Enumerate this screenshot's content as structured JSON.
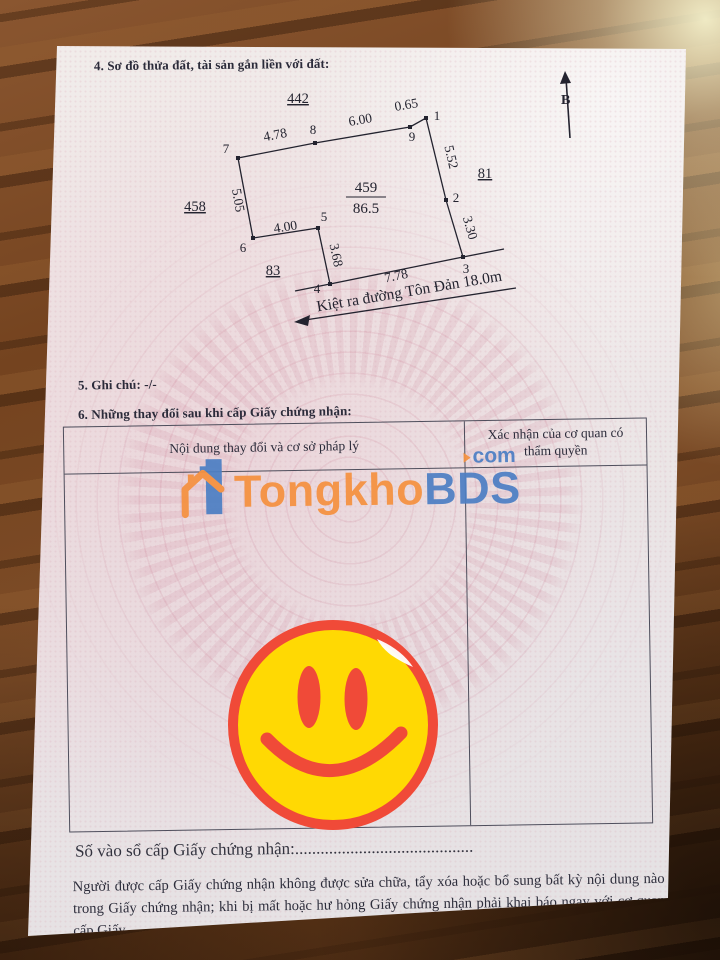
{
  "document": {
    "section4_title": "4. Sơ đồ thửa đất, tài sản gắn liền với đất:",
    "section5_note": "5. Ghi chú: -/-",
    "section6_title": "6. Những thay đổi sau khi cấp Giấy chứng nhận:",
    "table": {
      "col1_header": "Nội dung thay đổi và cơ sở pháp lý",
      "col2_header": "Xác nhận của cơ quan có thẩm quyền"
    },
    "registry_label": "Số vào sổ cấp Giấy chứng nhận:",
    "registry_dots": "..........................................",
    "footer_note": "Người được cấp Giấy chứng nhận không được sửa chữa, tẩy xóa hoặc bổ sung bất kỳ nội dung nào trong Giấy chứng nhận; khi bị mất hoặc hư hỏng Giấy chứng nhận phải khai báo ngay với cơ quan cấp Giấy."
  },
  "diagram": {
    "north_label": "B",
    "parcel_number": "459",
    "parcel_area": "86.5",
    "adjacent": {
      "top": "442",
      "left": "458",
      "right": "81",
      "bottom": "83"
    },
    "road_label": "Kiệt ra đường Tôn Đản 18.0m",
    "vertex_labels": [
      "1",
      "2",
      "3",
      "4",
      "5",
      "6",
      "7",
      "8",
      "9"
    ],
    "edges": [
      {
        "from": "1",
        "to": "2",
        "length": "5.52"
      },
      {
        "from": "2",
        "to": "3",
        "length": "3.30"
      },
      {
        "from": "3",
        "to": "4",
        "length": "7.78"
      },
      {
        "from": "4",
        "to": "5",
        "length": "3.68"
      },
      {
        "from": "5",
        "to": "6",
        "length": "4.00"
      },
      {
        "from": "6",
        "to": "7",
        "length": "5.05"
      },
      {
        "from": "7",
        "to": "8",
        "length": "4.78"
      },
      {
        "from": "8",
        "to": "9",
        "length": "6.00"
      },
      {
        "from": "9",
        "to": "1",
        "length": "0.65"
      }
    ]
  },
  "watermark": {
    "brand_part1": "Tongkho",
    "brand_part2": "BDS",
    "tld": "com",
    "orange": "#f5913f",
    "blue": "#4d7fc4"
  },
  "sticker": {
    "type": "smiley-face",
    "fill": "#ffd903",
    "accent": "#f04a38"
  }
}
